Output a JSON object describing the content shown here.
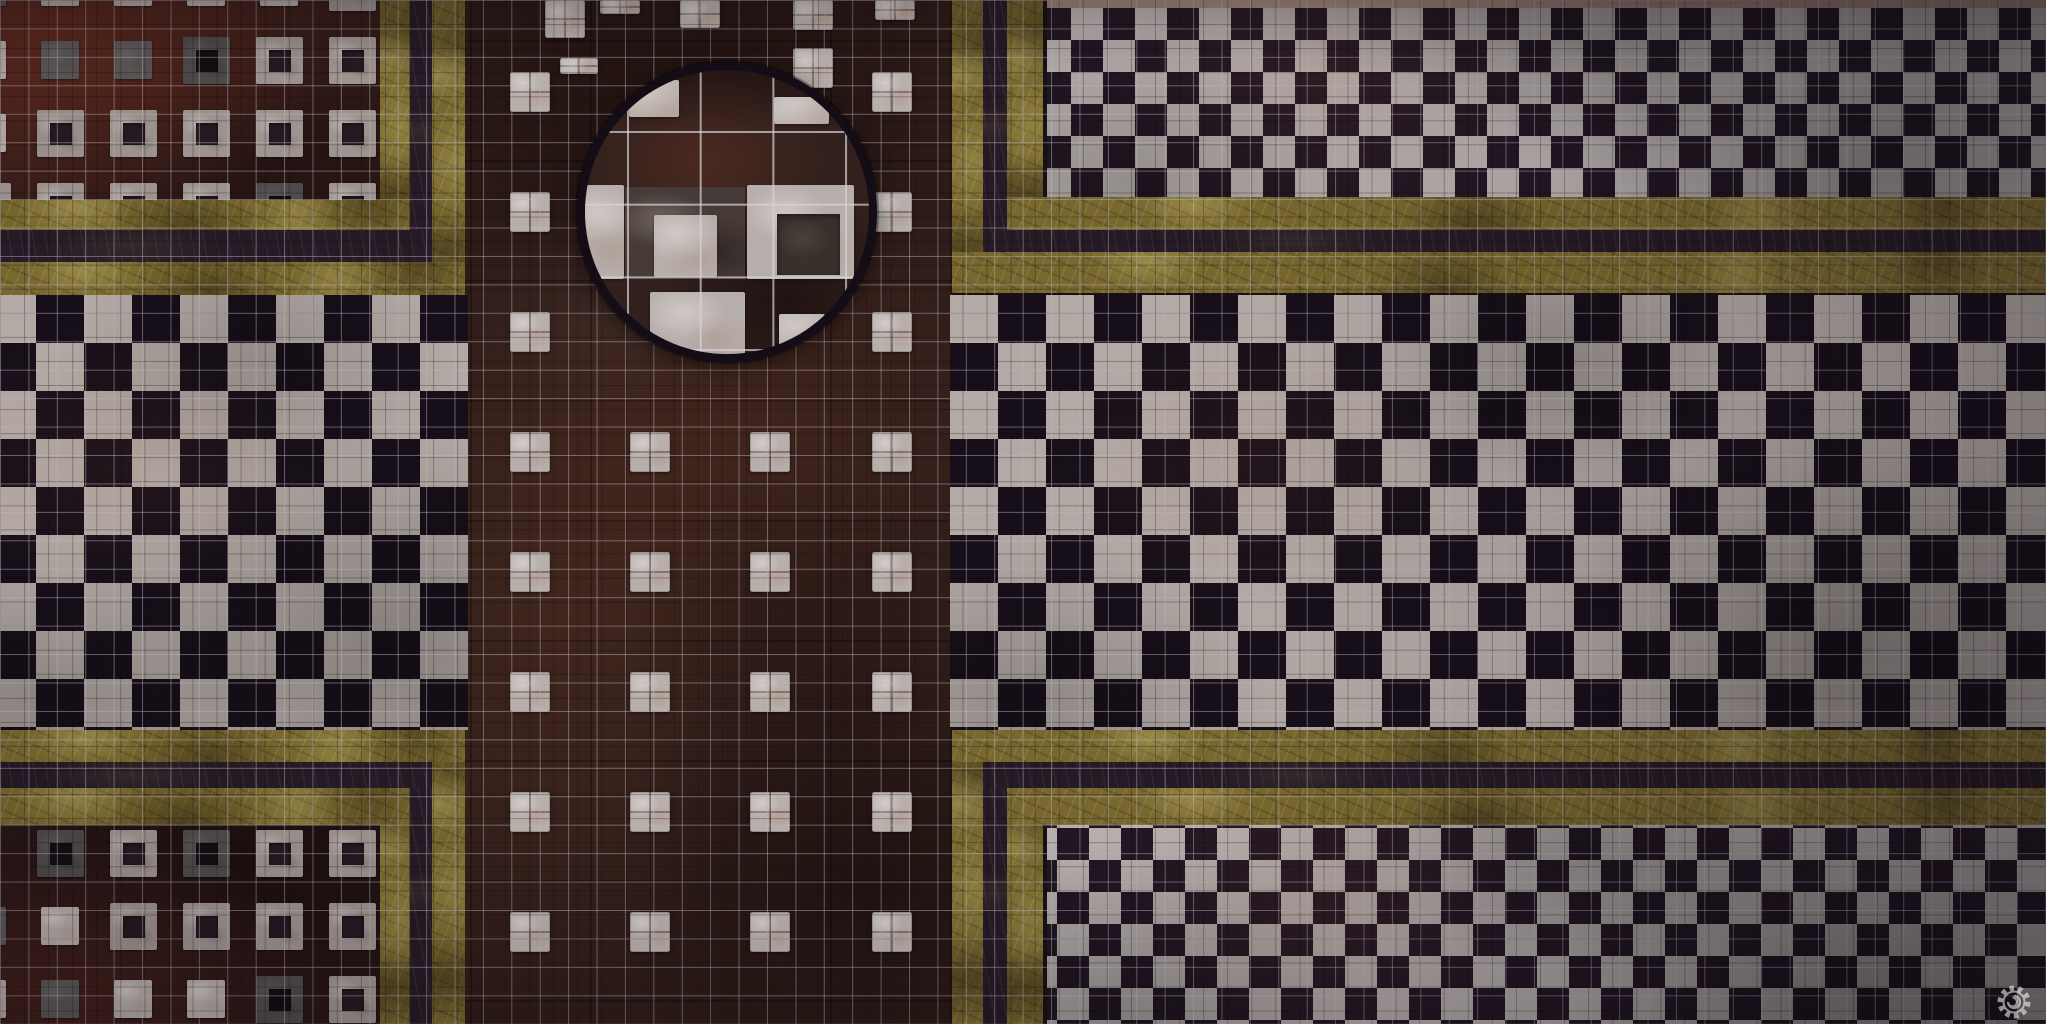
{
  "map": {
    "kind": "marble-floor-battle-map",
    "width": 2046,
    "height": 1024,
    "seed": 1337
  },
  "palette": {
    "checker_white": "#c3bab3",
    "checker_dark": "#150e17",
    "diamond_white": "#c7c0bc",
    "diamond_dark": "#211621",
    "gold_base": "#81702e",
    "stripe_dark": "#251a24",
    "tile_white": "#c9c0b9",
    "ss_outer": "#aba19a",
    "ss_hole": "#251a21",
    "lens_ring": "#120c15",
    "lens_bg": "#33211a",
    "lens_slab": "#4b3f38",
    "lens_tile": "#c7bfb8",
    "lens_hole": "#3b332c",
    "grid_line": "rgba(203,198,209,0.48)",
    "seam_line": "rgba(10,5,7,0.28)",
    "lens_grid_line": "rgba(234,232,238,0.7)",
    "watermark": "#ffffff"
  },
  "grid": {
    "cell_w": 28.4167,
    "cell_h": 28.4444,
    "seam_cell": 24.07,
    "lens_cell": 72.7
  },
  "corridor": {
    "x": 465,
    "y": 0,
    "w": 487,
    "h": 1024,
    "cluster_size": 40,
    "cluster_cols": [
      510,
      630,
      750,
      872
    ],
    "cluster_rows": [
      72,
      192,
      312,
      432,
      552,
      672,
      792,
      912
    ],
    "lens_avoid_radius": 165,
    "extras": [
      [
        545,
        0,
        40,
        38
      ],
      [
        600,
        0,
        40,
        14
      ],
      [
        680,
        0,
        40,
        28
      ],
      [
        793,
        0,
        40,
        30
      ],
      [
        875,
        0,
        40,
        20
      ],
      [
        560,
        58,
        38,
        16
      ],
      [
        793,
        48,
        40,
        40
      ]
    ]
  },
  "checkers": {
    "cell": 48,
    "left": {
      "x": 0,
      "y": 295,
      "w": 468,
      "h": 435,
      "phase": "-12px 0px"
    },
    "right": {
      "x": 950,
      "y": 295,
      "w": 1096,
      "h": 435,
      "phase": "0px 0px"
    }
  },
  "diamonds": {
    "cell": 64,
    "top_right": {
      "x": 1047,
      "y": 8,
      "w": 999,
      "h": 189,
      "pos": "24px 0px, 56px 32px"
    },
    "bottom_right": {
      "x": 1047,
      "y": 825,
      "w": 999,
      "h": 199,
      "pos": "10px 35px, 42px 67px"
    }
  },
  "pink_strip": {
    "x": 1047,
    "y": 0,
    "w": 999,
    "h": 8
  },
  "fields": {
    "top_left": {
      "x": 0,
      "y": 0,
      "w": 380,
      "h": 200,
      "pitch": 73,
      "tile": 47,
      "hole": 22,
      "plain": 38,
      "col0": -36,
      "row0": -36,
      "ncols": 6,
      "nrows": 4,
      "dense_corner": "bottom-right"
    },
    "bottom_left": {
      "x": 0,
      "y": 825,
      "w": 380,
      "h": 199,
      "pitch": 73,
      "tile": 47,
      "hole": 22,
      "plain": 38,
      "col0": -36,
      "row0": 830,
      "ncols": 6,
      "nrows": 3,
      "dense_corner": "top-right"
    }
  },
  "borders": {
    "top_left": [
      [
        380,
        0,
        30,
        230,
        "gold"
      ],
      [
        0,
        200,
        410,
        30,
        "gold"
      ],
      [
        410,
        0,
        22,
        262,
        "dark"
      ],
      [
        0,
        230,
        432,
        32,
        "dark"
      ],
      [
        432,
        0,
        33,
        295,
        "gold"
      ],
      [
        0,
        262,
        465,
        33,
        "gold"
      ]
    ],
    "top_right": [
      [
        1007,
        0,
        36,
        230,
        "gold"
      ],
      [
        1007,
        197,
        1039,
        33,
        "gold"
      ],
      [
        983,
        0,
        24,
        252,
        "dark"
      ],
      [
        983,
        230,
        1063,
        22,
        "dark"
      ],
      [
        952,
        0,
        31,
        293,
        "gold"
      ],
      [
        952,
        252,
        1094,
        41,
        "gold"
      ]
    ],
    "bottom_left": [
      [
        380,
        788,
        30,
        236,
        "gold"
      ],
      [
        0,
        788,
        410,
        37,
        "gold"
      ],
      [
        410,
        762,
        22,
        262,
        "dark"
      ],
      [
        0,
        762,
        432,
        26,
        "dark"
      ],
      [
        432,
        730,
        33,
        294,
        "gold"
      ],
      [
        0,
        730,
        465,
        32,
        "gold"
      ]
    ],
    "bottom_right": [
      [
        1007,
        788,
        36,
        236,
        "gold"
      ],
      [
        1007,
        788,
        1039,
        37,
        "gold"
      ],
      [
        983,
        762,
        24,
        262,
        "dark"
      ],
      [
        983,
        762,
        1063,
        26,
        "dark"
      ],
      [
        952,
        730,
        31,
        294,
        "gold"
      ],
      [
        952,
        730,
        1094,
        32,
        "gold"
      ]
    ]
  },
  "lens": {
    "x": 577,
    "y": 62,
    "d": 300,
    "ring": 8,
    "grid_offset": [
      42,
      61
    ],
    "tiles": [
      [
        0,
        0,
        300,
        69,
        "shade"
      ],
      [
        52,
        18,
        50,
        37,
        "tile"
      ],
      [
        197,
        35,
        55,
        27,
        "tile"
      ],
      [
        7,
        123,
        40,
        94,
        "tile"
      ],
      [
        48,
        125,
        120,
        92,
        "slab"
      ],
      [
        170,
        123,
        107,
        94,
        "tile"
      ],
      [
        200,
        152,
        63,
        61,
        "hole"
      ],
      [
        77,
        153,
        63,
        62,
        "tile"
      ],
      [
        73,
        230,
        95,
        70,
        "tile"
      ],
      [
        202,
        252,
        46,
        41,
        "tile"
      ]
    ]
  },
  "watermark": {
    "x": 1994,
    "y": 982,
    "size": 40,
    "opacity": 0.55
  }
}
